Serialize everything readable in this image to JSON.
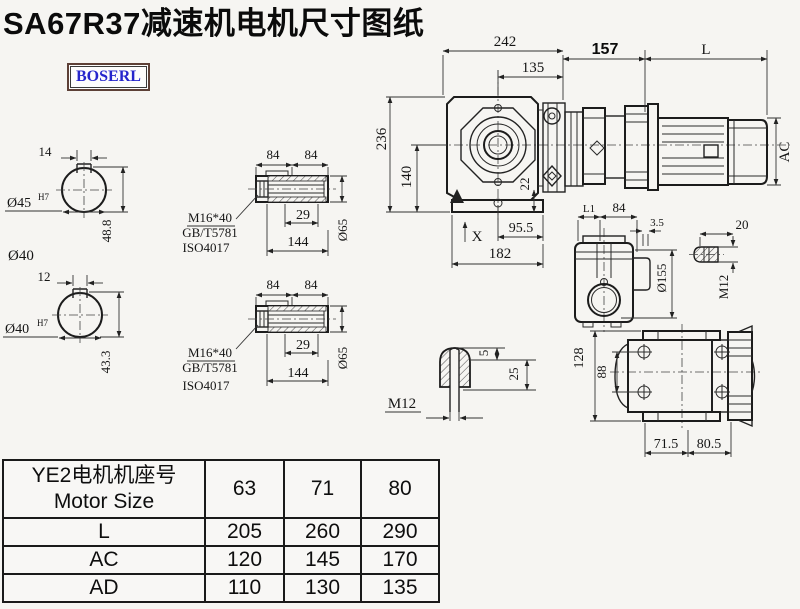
{
  "title": "SA67R37减速机电机尺寸图纸",
  "logo": "BOSERL",
  "shaft1": {
    "key_width": "14",
    "bore": "Ø45",
    "fit": "H7",
    "height": "48.8",
    "outer_label": "Ø40"
  },
  "shaft2": {
    "key_width": "12",
    "bore": "Ø40",
    "fit": "H7",
    "height": "43.3"
  },
  "sleeve1": {
    "seg1": "84",
    "seg2": "84",
    "depth": "29",
    "length": "144",
    "dia": "Ø65",
    "bolt": "M16*40",
    "std1": "GB/T5781",
    "std2": "ISO4017"
  },
  "sleeve2": {
    "seg1": "84",
    "seg2": "84",
    "depth": "29",
    "length": "144",
    "dia": "Ø65",
    "bolt": "M16*40",
    "std1": "GB/T5781",
    "std2": "ISO4017"
  },
  "front": {
    "width": "242",
    "center_to_right": "135",
    "height": "236",
    "center_height": "140",
    "flange": "22",
    "foot_right": "95.5",
    "base": "182",
    "mark": "X"
  },
  "motor": {
    "adapter": "157",
    "length_label": "L",
    "diameter_label": "AC"
  },
  "side": {
    "l1": "L1",
    "width": "84",
    "wall": "3.5",
    "thread_len": "20",
    "flange_dia": "Ø155",
    "stud": "M12"
  },
  "bolt_detail": {
    "top": "5",
    "depth": "25",
    "thread": "M12"
  },
  "bottom_view": {
    "height": "128",
    "bolt_spacing": "88",
    "foot1": "71.5",
    "foot2": "80.5"
  },
  "table": {
    "header_cn": "YE2电机机座号",
    "header_en": "Motor Size",
    "columns": [
      "63",
      "71",
      "80"
    ],
    "rows": [
      {
        "label": "L",
        "values": [
          "205",
          "260",
          "290"
        ]
      },
      {
        "label": "AC",
        "values": [
          "120",
          "145",
          "170"
        ]
      },
      {
        "label": "AD",
        "values": [
          "110",
          "130",
          "135"
        ]
      }
    ]
  }
}
